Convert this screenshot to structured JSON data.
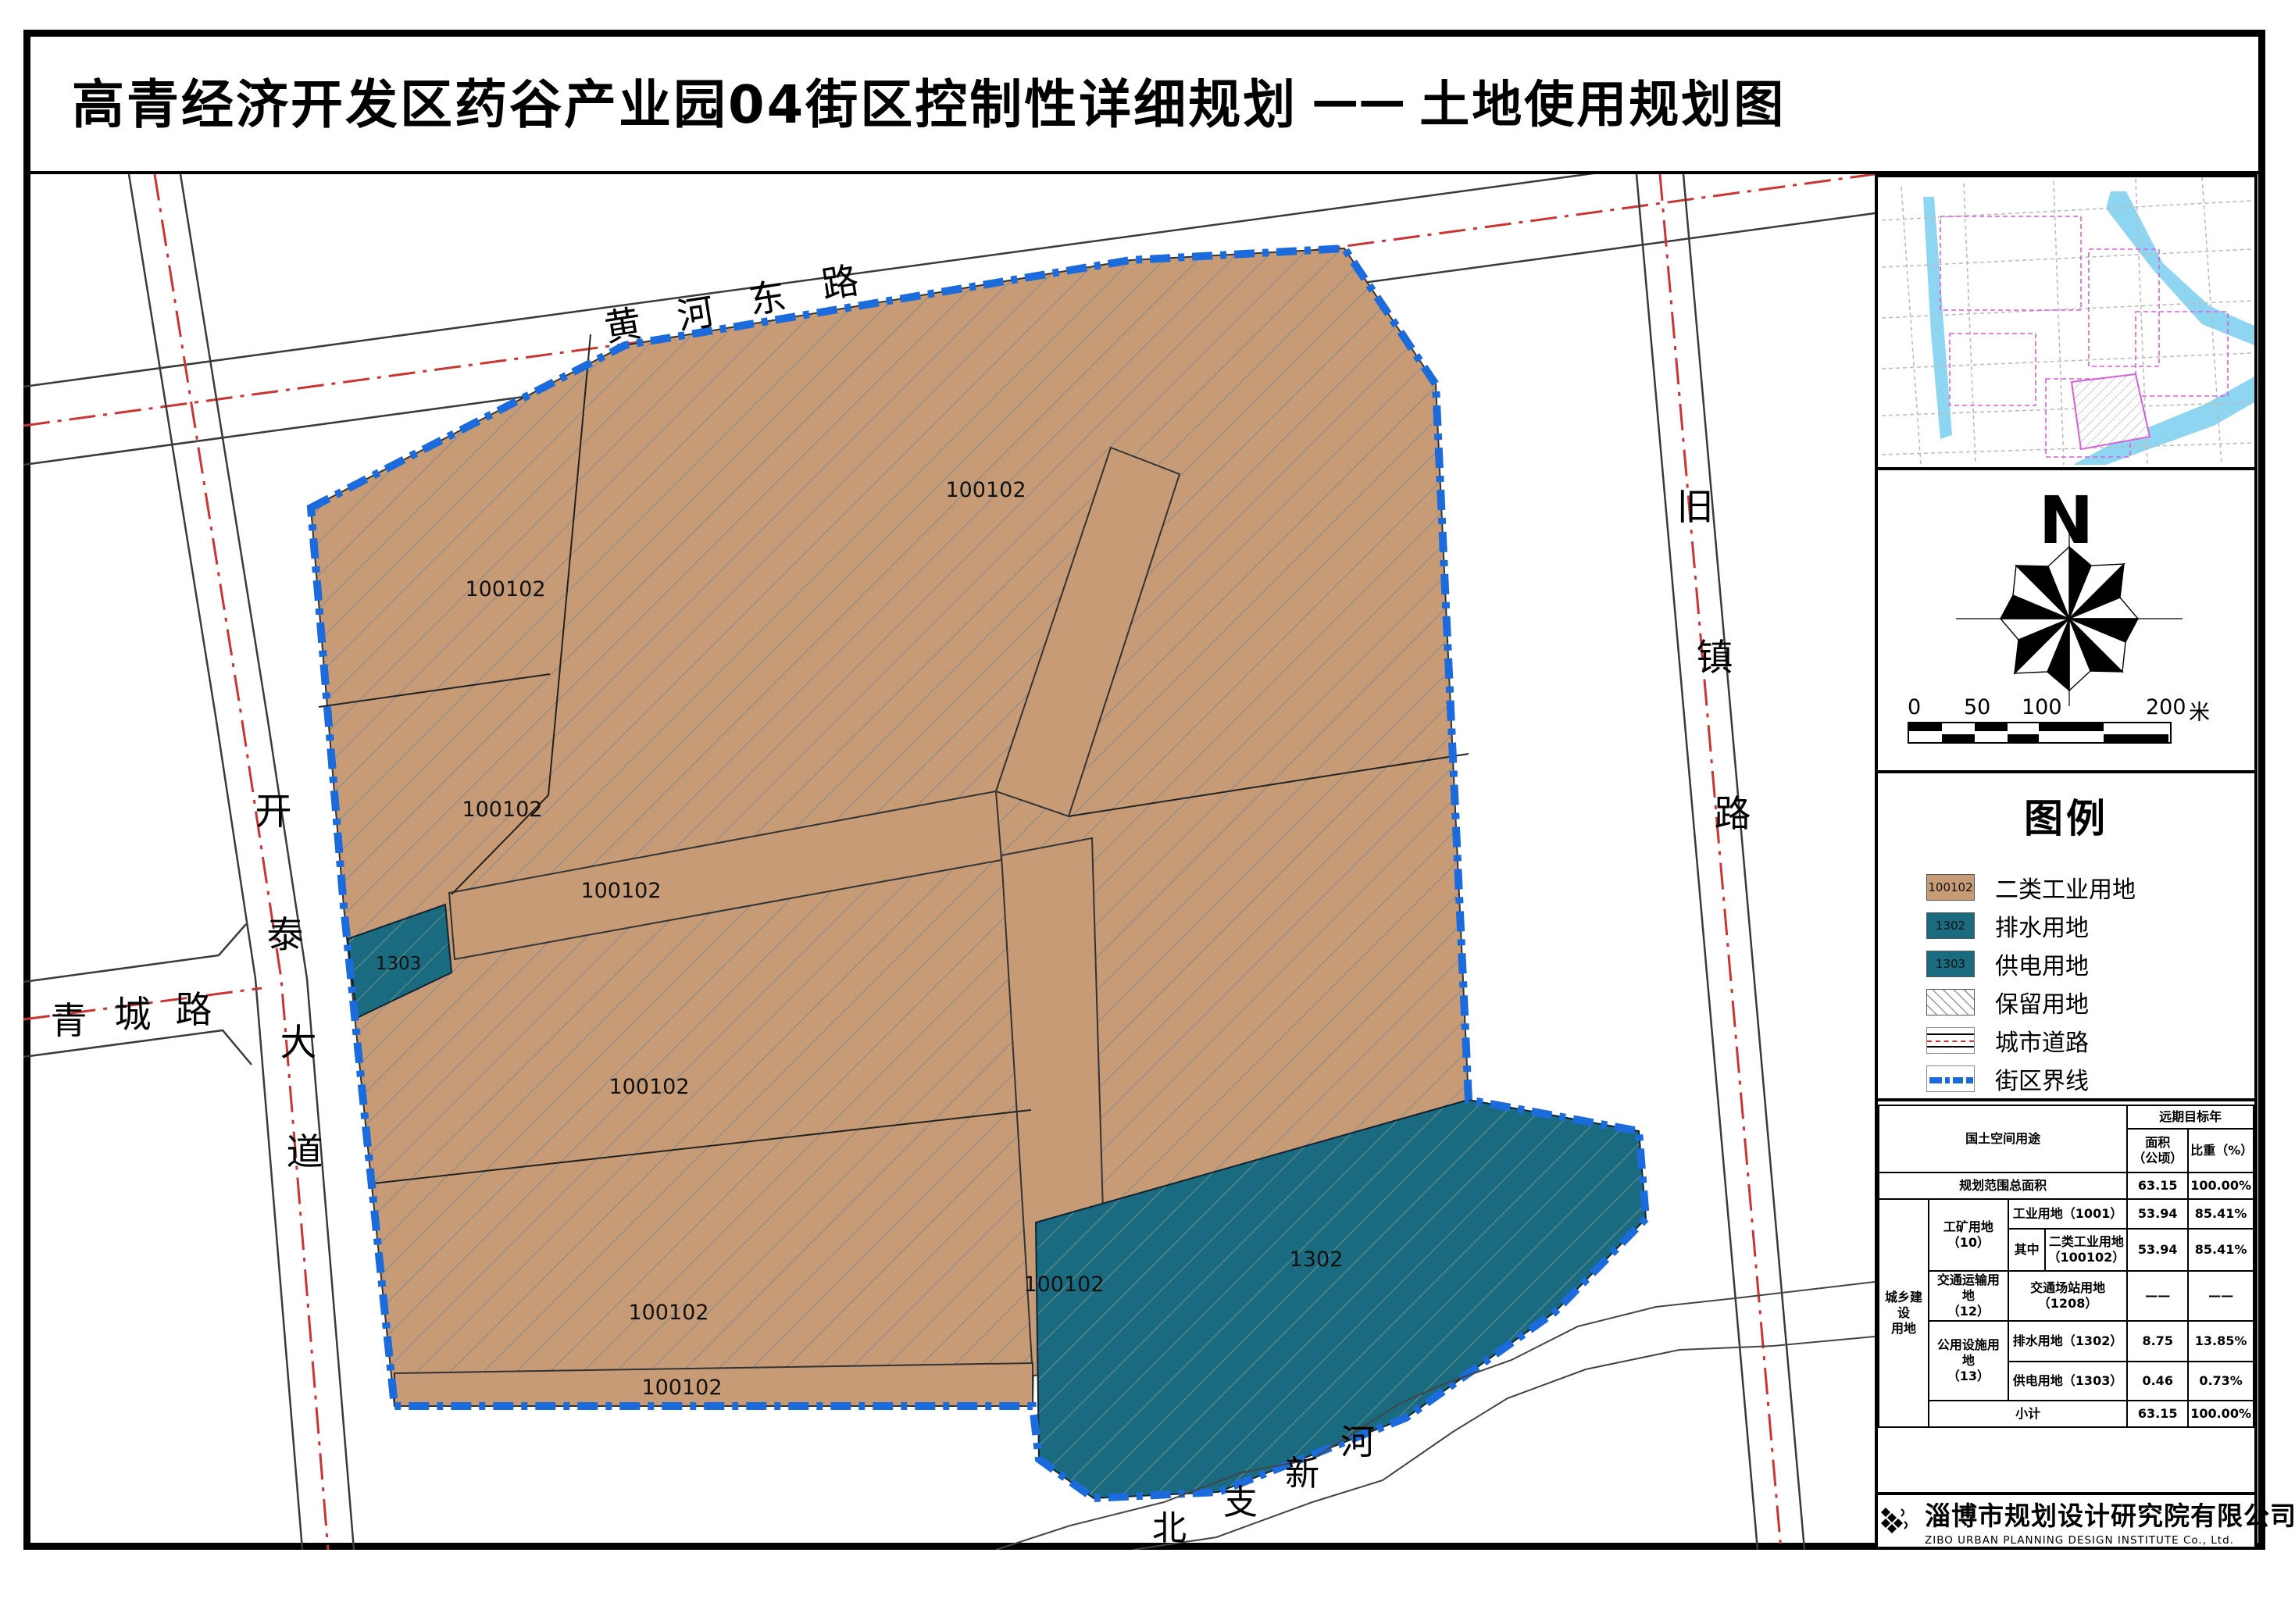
{
  "title": {
    "main": "高青经济开发区药谷产业园04街区控制性详细规划",
    "dash": "——",
    "sub": "土地使用规划图"
  },
  "map": {
    "road_labels": {
      "huanghe": [
        "黄",
        "河",
        "东",
        "路"
      ],
      "kaitai": [
        "开",
        "泰",
        "大",
        "道"
      ],
      "qingcheng": [
        "青",
        "城",
        "路"
      ],
      "jiuzhen": [
        "旧",
        "镇",
        "路"
      ],
      "river": [
        "北",
        "支",
        "新",
        "河"
      ]
    },
    "parcel_labels": {
      "industrial": "100102",
      "drain": "1302",
      "power": "1303"
    }
  },
  "compass": {
    "north_label": "N"
  },
  "scalebar": {
    "ticks": [
      "0",
      "50",
      "100",
      "200"
    ],
    "unit": "米"
  },
  "legend": {
    "title": "图例",
    "items": [
      {
        "code": "100102",
        "label": "二类工业用地",
        "type": "fill-tan"
      },
      {
        "code": "1302",
        "label": "排水用地",
        "type": "fill-teal"
      },
      {
        "code": "1303",
        "label": "供电用地",
        "type": "fill-teal"
      },
      {
        "code": "",
        "label": "保留用地",
        "type": "hatch"
      },
      {
        "code": "",
        "label": "城市道路",
        "type": "road"
      },
      {
        "code": "",
        "label": "街区界线",
        "type": "boundary"
      }
    ]
  },
  "table": {
    "headers": {
      "use": "国土空间用途",
      "target_year": "远期目标年",
      "area": "面积\n（公顷）",
      "ratio": "比重（%）"
    },
    "rows": {
      "total_label": "规划范围总面积",
      "total_area": "63.15",
      "total_ratio": "100.00%",
      "group": "城乡建设\n用地",
      "mining": "工矿用地\n（10）",
      "industry": "工业用地（1001）",
      "industry_area": "53.94",
      "industry_ratio": "85.41%",
      "among": "其中",
      "class2": "二类工业用地\n（100102）",
      "class2_area": "53.94",
      "class2_ratio": "85.41%",
      "transport": "交通运输用地\n（12）",
      "station": "交通场站用地（1208）",
      "station_area": "——",
      "station_ratio": "——",
      "utility": "公用设施用地\n（13）",
      "drain": "排水用地（1302）",
      "drain_area": "8.75",
      "drain_ratio": "13.85%",
      "power": "供电用地（1303）",
      "power_area": "0.46",
      "power_ratio": "0.73%",
      "subtotal": "小计",
      "subtotal_area": "63.15",
      "subtotal_ratio": "100.00%"
    }
  },
  "footer": {
    "company_cn": "淄博市规划设计研究院有限公司",
    "company_en": "ZIBO URBAN PLANNING DESIGN INSTITUTE Co., Ltd.",
    "page_number": "06"
  },
  "colors": {
    "industrial_tan": "#C69B76",
    "utility_teal": "#1A6B80",
    "block_boundary_blue": "#1B6BDC",
    "road_centerline_red": "#CC3333",
    "minimap_river_cyan": "#8ED5F2",
    "minimap_parcel_magenta": "#D95FD9"
  }
}
